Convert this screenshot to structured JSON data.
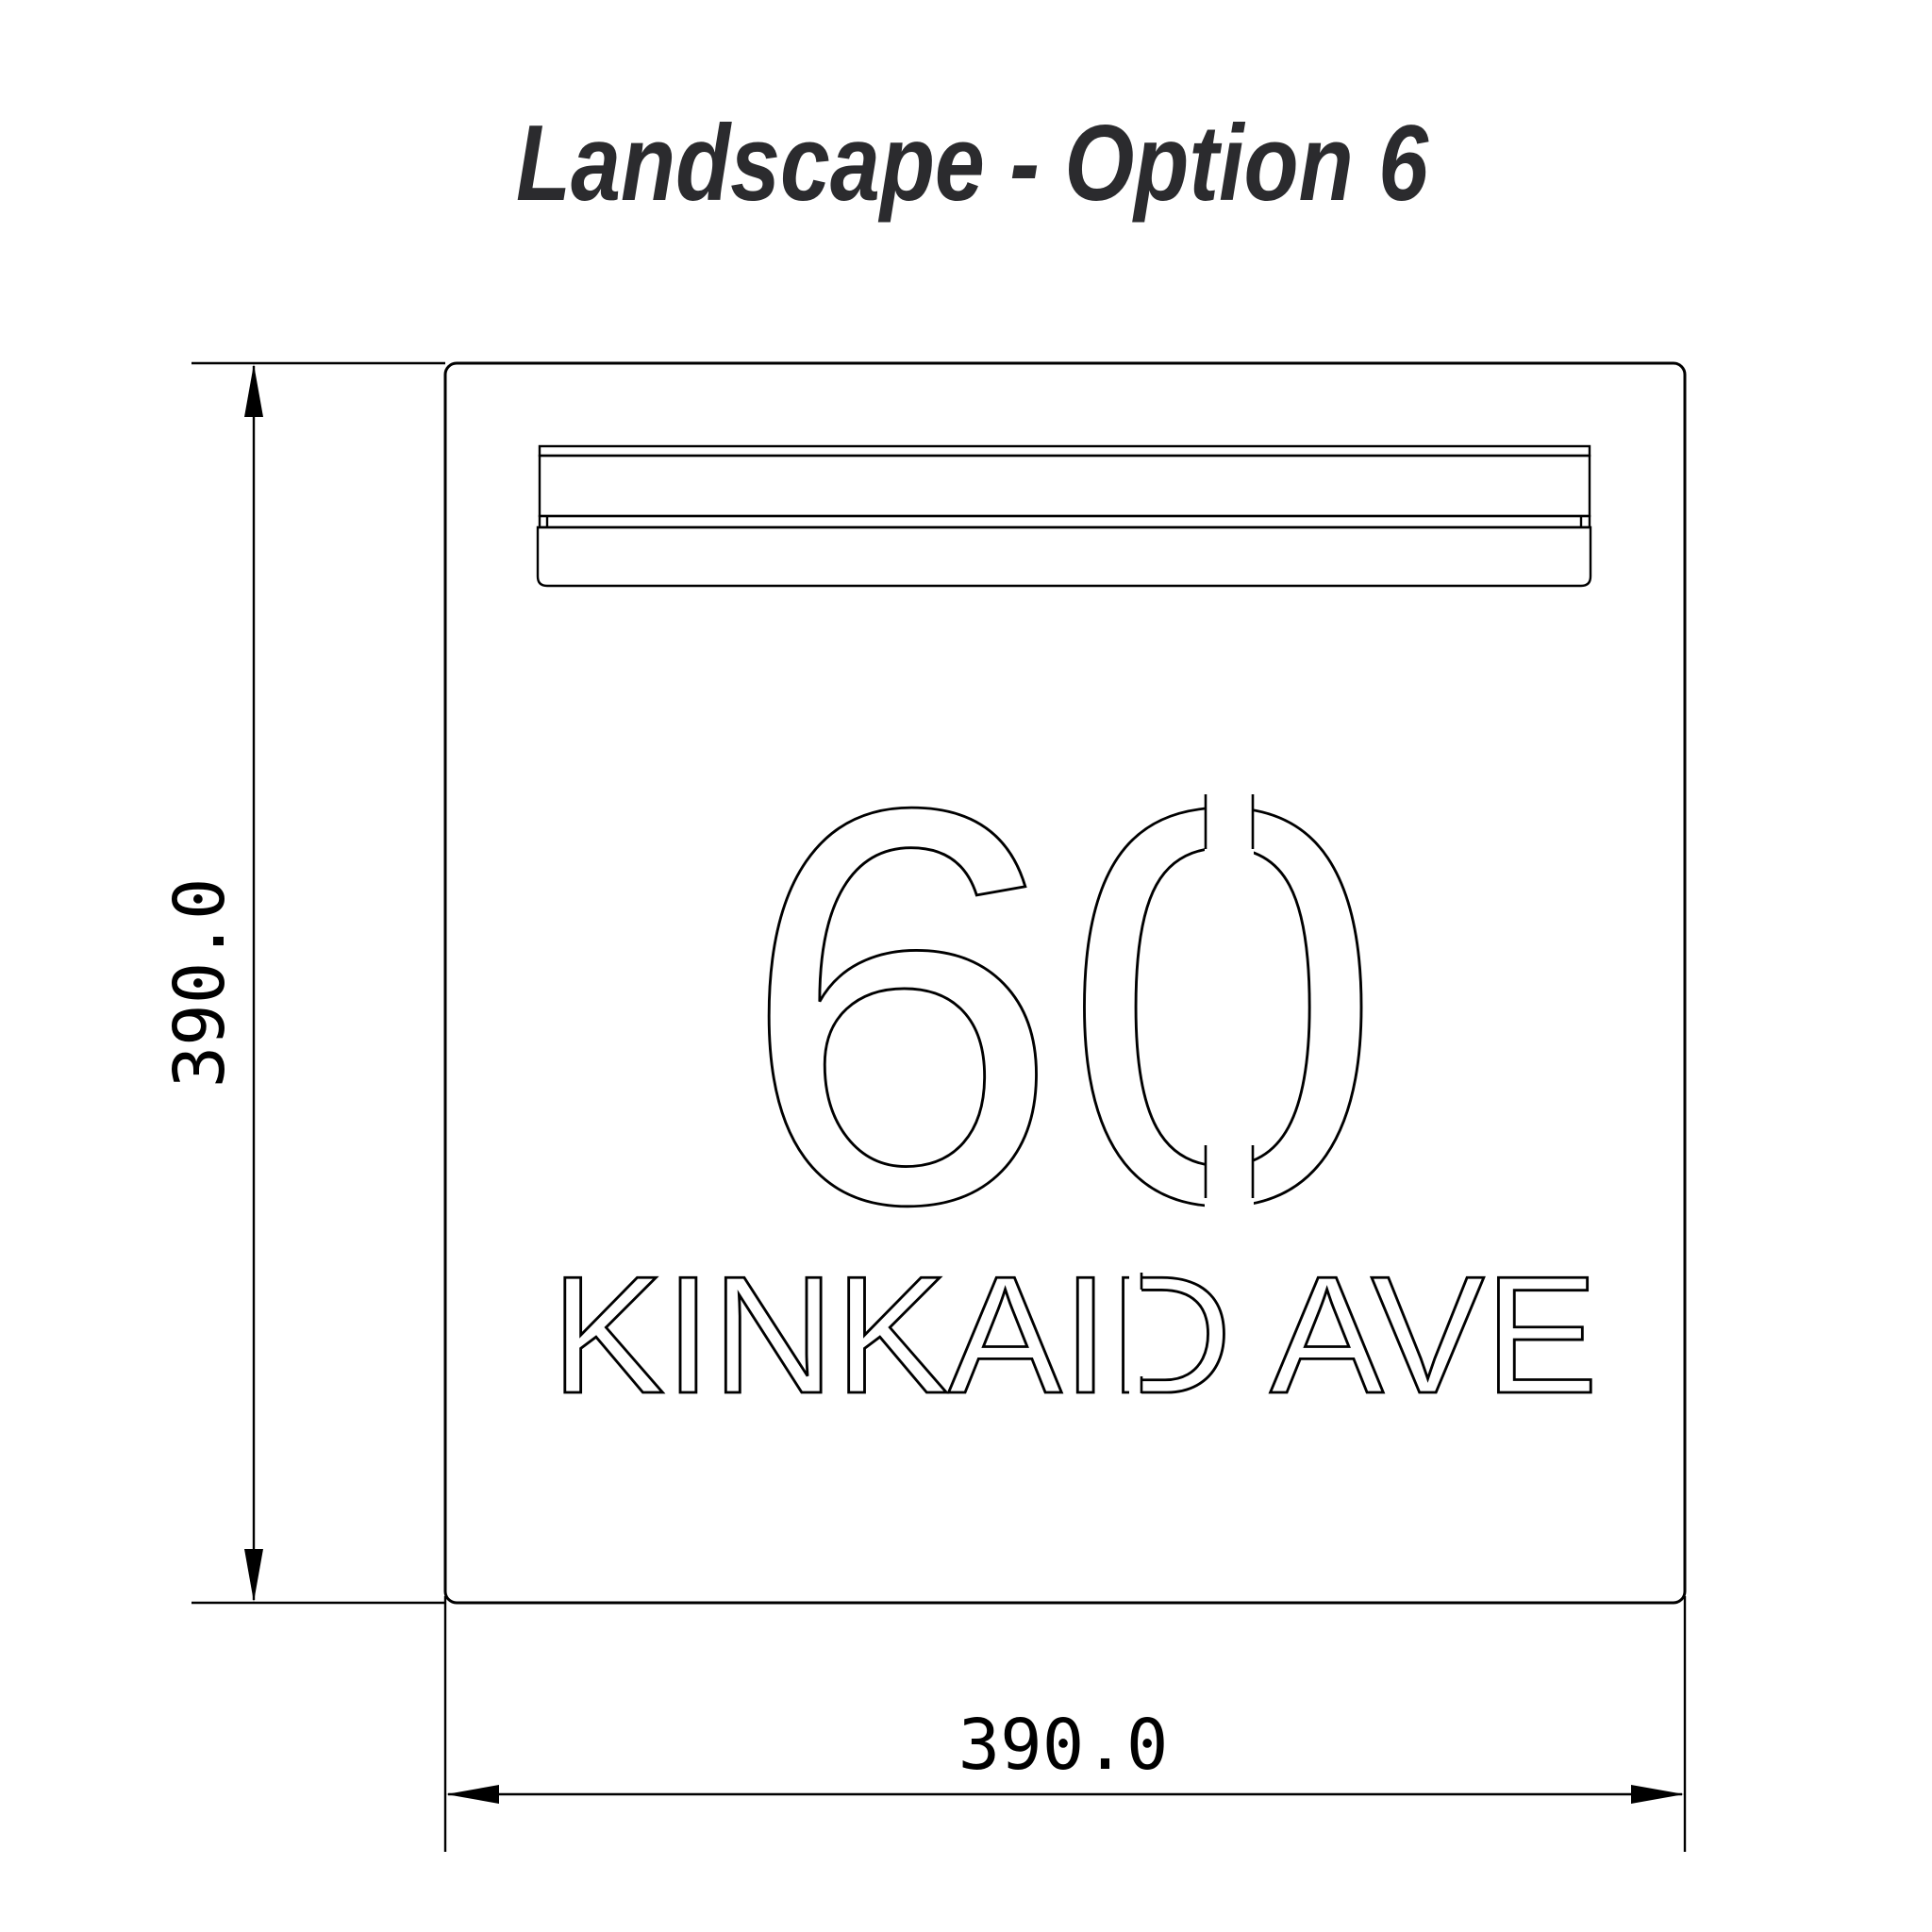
{
  "title": "Landscape - Option 6",
  "sign": {
    "number": "60",
    "street": "KINKAID AVE"
  },
  "dimensions": {
    "height_label": "390.0",
    "width_label": "390.0"
  },
  "colors": {
    "line": "#000000",
    "title_text": "#2b2b2e",
    "background": "#ffffff"
  }
}
